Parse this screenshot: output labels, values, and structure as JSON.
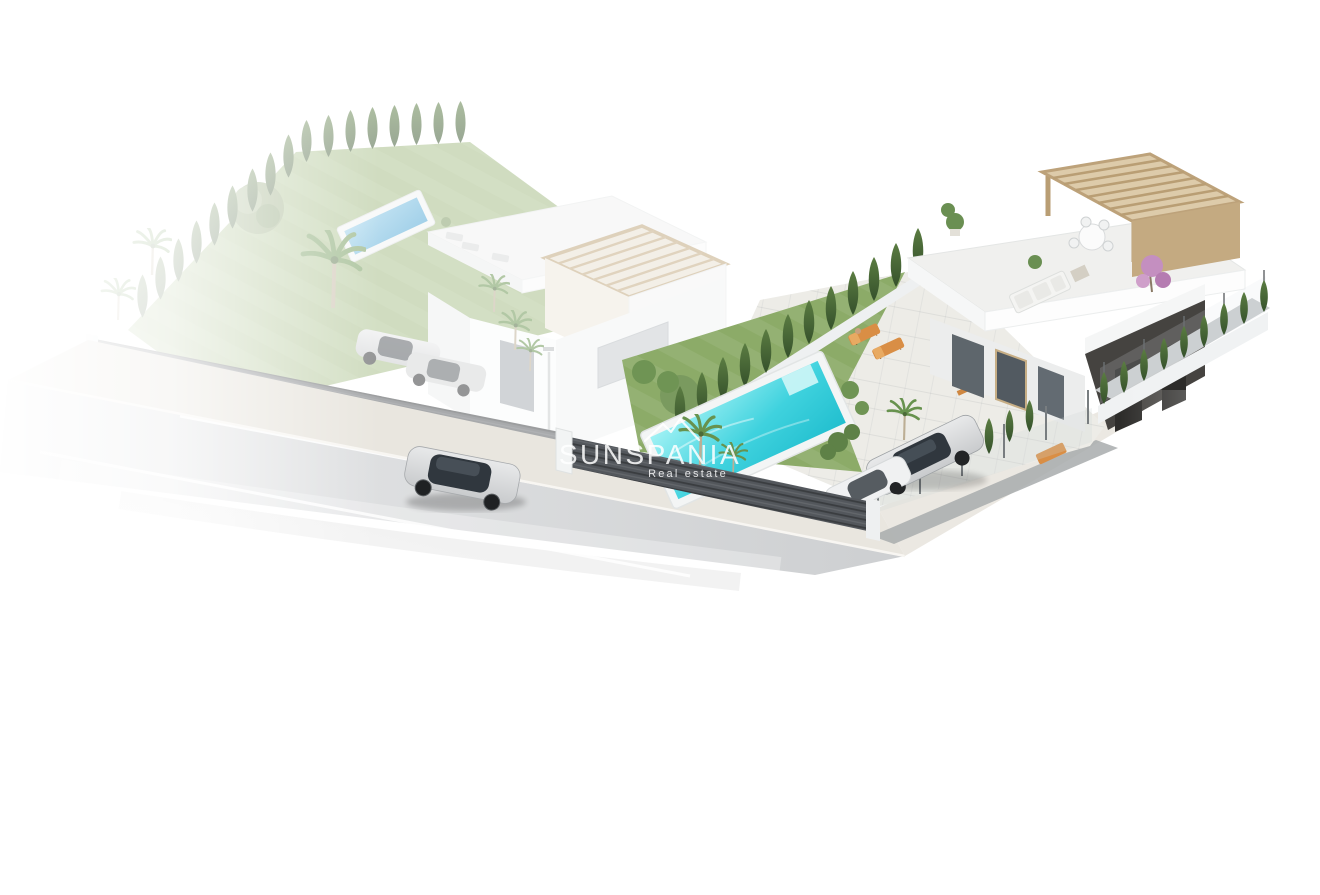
{
  "page": {
    "background": "#ffffff"
  },
  "watermark": {
    "logo_icon": "mountains-icon",
    "title": "SUNSPANIA",
    "subtitle": "Real estate"
  },
  "scene": {
    "type": "isometric-3d-architectural-render",
    "objects": [
      "left-villa-with-pergola-tower",
      "left-garden-with-pool-and-palms",
      "right-villa-with-roof-terrace-and-pergola",
      "right-garden-lawn-with-turquoise-pool",
      "cypress-hedges-and-boundary-fences",
      "asphalt-road-with-silver-car",
      "sidewalk",
      "two-parked-cars-behind-fence",
      "outdoor-furniture-orange-loungers-and-picnic-table"
    ]
  },
  "colors": {
    "watermark": "rgba(255,255,255,0.85)",
    "road_light": "#e9eaeb",
    "road_dark": "#cdcfd1",
    "sidewalk": "#e9e6df",
    "paving": "#edece7",
    "lawn": "#8cab68",
    "lawn_light": "#a3bb82",
    "cypress_dark": "#35512b",
    "cypress_light": "#5b7d42",
    "palm_green": "#67924e",
    "pool_light": "#9ff1f4",
    "pool_deep": "#22bfcf",
    "left_pool": "#47a3d4",
    "fence": "#53575c",
    "villa_white": "#f5f6f6",
    "villa_shade": "#e2e4e6",
    "pergola": "#cfb795",
    "pergola_dark": "#b1946c",
    "dark_wall": "#454340",
    "dark_glass": "#2d2c2a",
    "glass": "#5e666c",
    "car_silver": "#c9cbcd",
    "car_glass": "#30373e",
    "car_white": "#f0f1f2",
    "furniture_orange": "#d98e45",
    "bougainvillea": "#c48fc0"
  }
}
